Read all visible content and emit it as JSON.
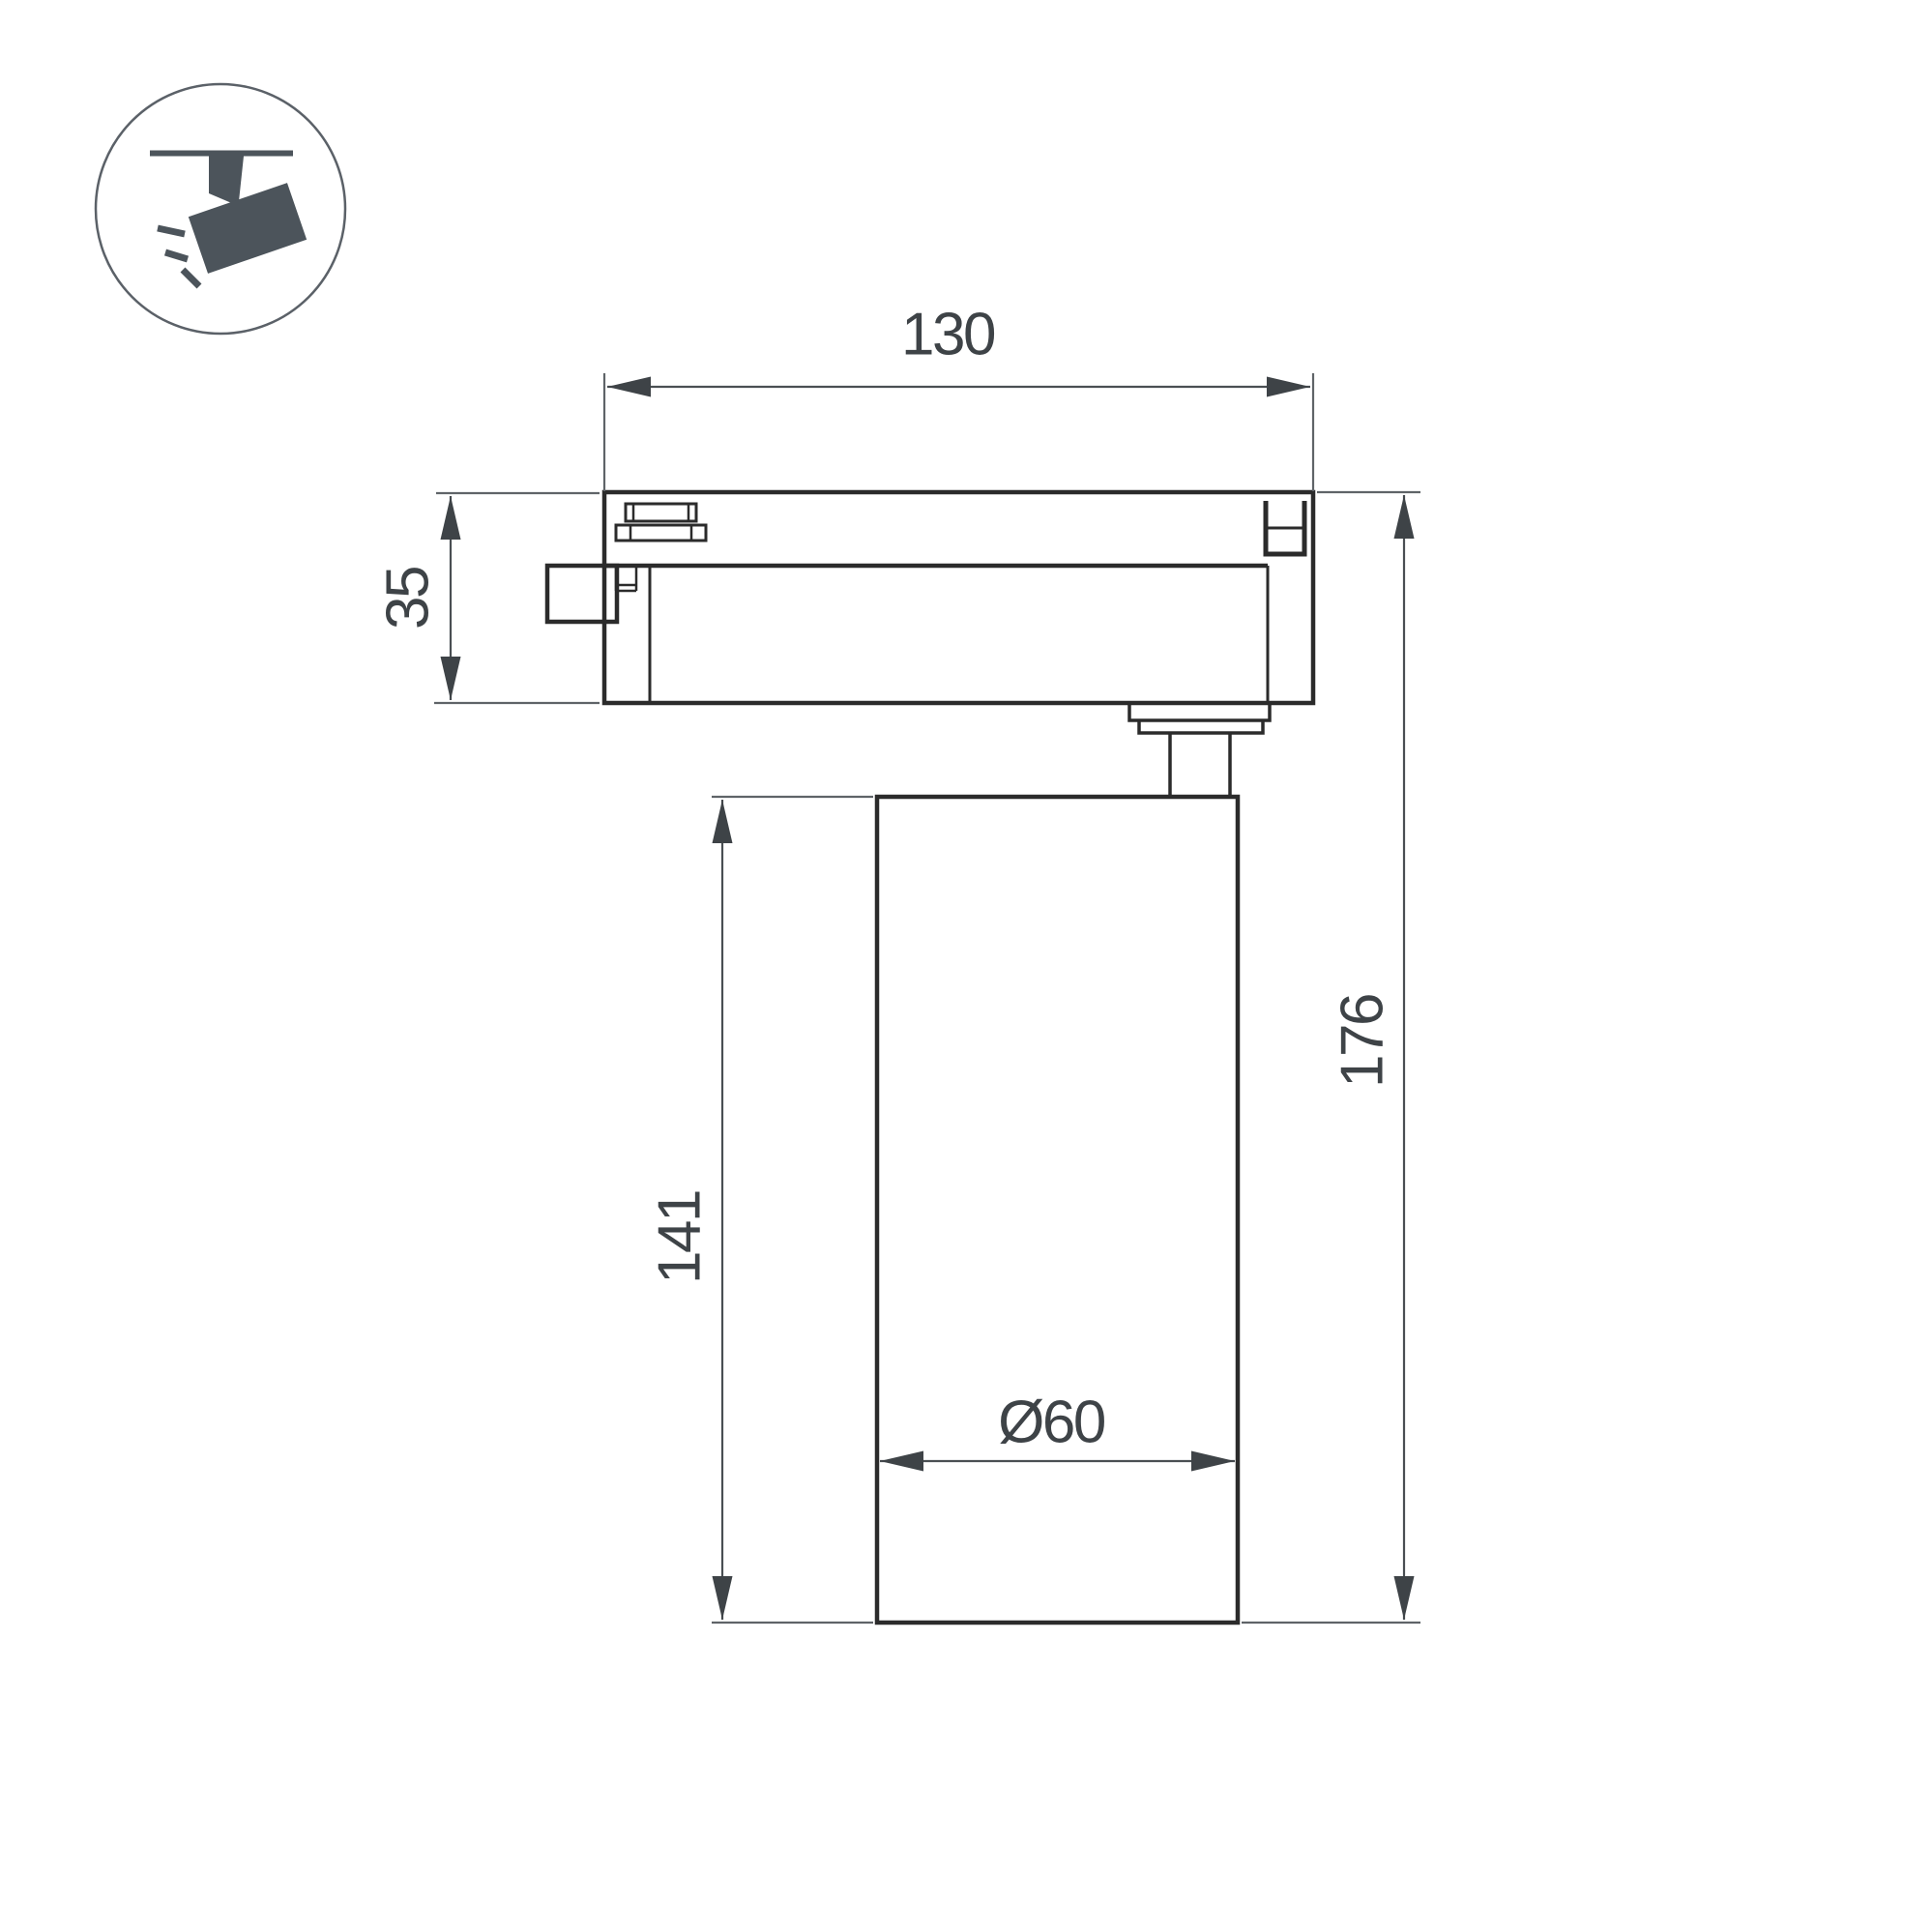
{
  "title": "Track spotlight dimensional drawing",
  "icon": {
    "name": "track-spotlight-pictogram"
  },
  "dimensions": {
    "track_width": "130",
    "adapter_height": "35",
    "body_length": "141",
    "total_height": "176",
    "diameter": "Ø60"
  },
  "colors": {
    "background": "#ffffff",
    "outline-strong": "#2b2b2b",
    "outline-thin": "#5f6468",
    "dim-line": "#4a4f53",
    "dim-text": "#3e4347",
    "icon-fill": "#4c545b",
    "icon-circle": "#5b6168"
  }
}
